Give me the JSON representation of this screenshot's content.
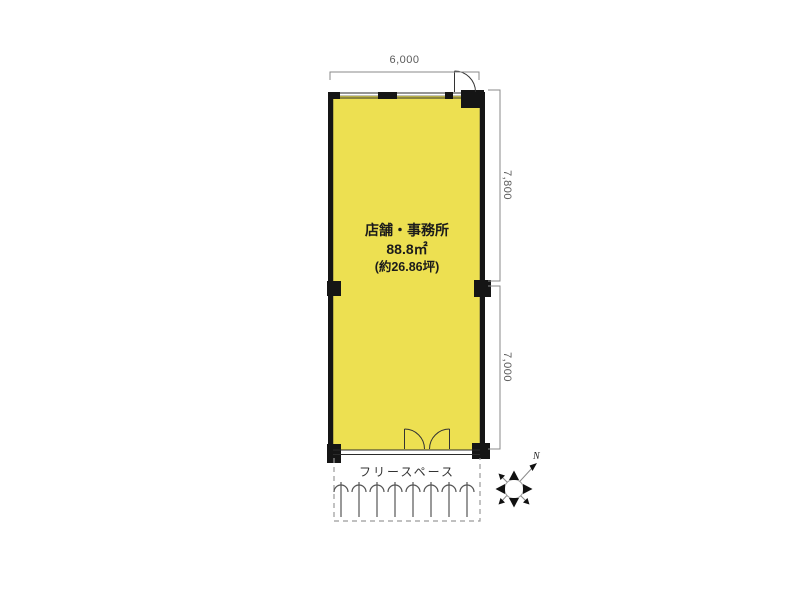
{
  "floorplan": {
    "room": {
      "name": "店舗・事務所",
      "area_m2": "88.8㎡",
      "area_tsubo": "(約26.86坪)"
    },
    "dimensions": {
      "top_width_mm": "6,000",
      "right_upper_mm": "7,800",
      "right_lower_mm": "7,000"
    },
    "free_space": {
      "label": "フリースペース",
      "bicycle_rack_count": 8
    },
    "compass": {
      "north_label": "N"
    },
    "colors": {
      "room_fill": "#EDE051",
      "wall": "#151515",
      "dimension_line": "#8a8a8a",
      "dashed_boundary": "#9a9a9a",
      "background": "#ffffff"
    }
  }
}
